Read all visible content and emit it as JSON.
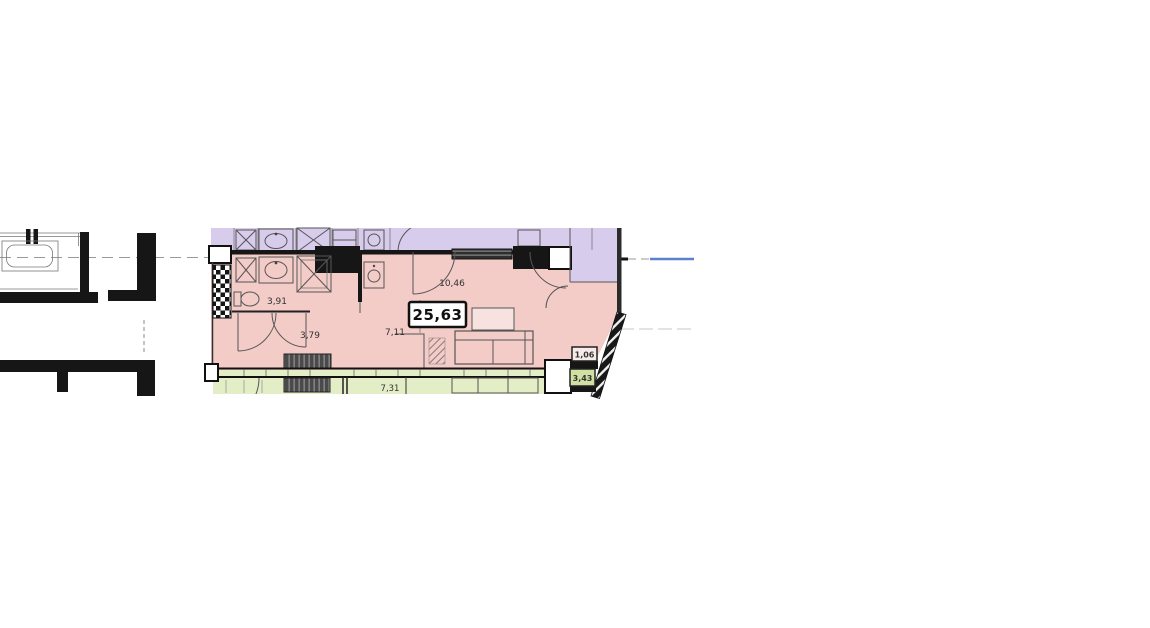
{
  "plan": {
    "total_area_badge": "25,63",
    "area_labels": {
      "bathroom": "3,91",
      "hallway": "3,79",
      "kitchen": "7,11",
      "living_room": "10,46",
      "balcony_upper": "1,06",
      "balcony_lower": "3,43",
      "unit_below_room": "7,31"
    },
    "colors": {
      "unit-pink": "#f3cbc7",
      "neighbor-purple": "#d8ccec",
      "neighbor-green": "#e3edc6",
      "badge-green": "#cfe0a2",
      "wall-black": "#161616",
      "line-gray": "#555555",
      "axis-blue": "#5b82c8"
    }
  }
}
